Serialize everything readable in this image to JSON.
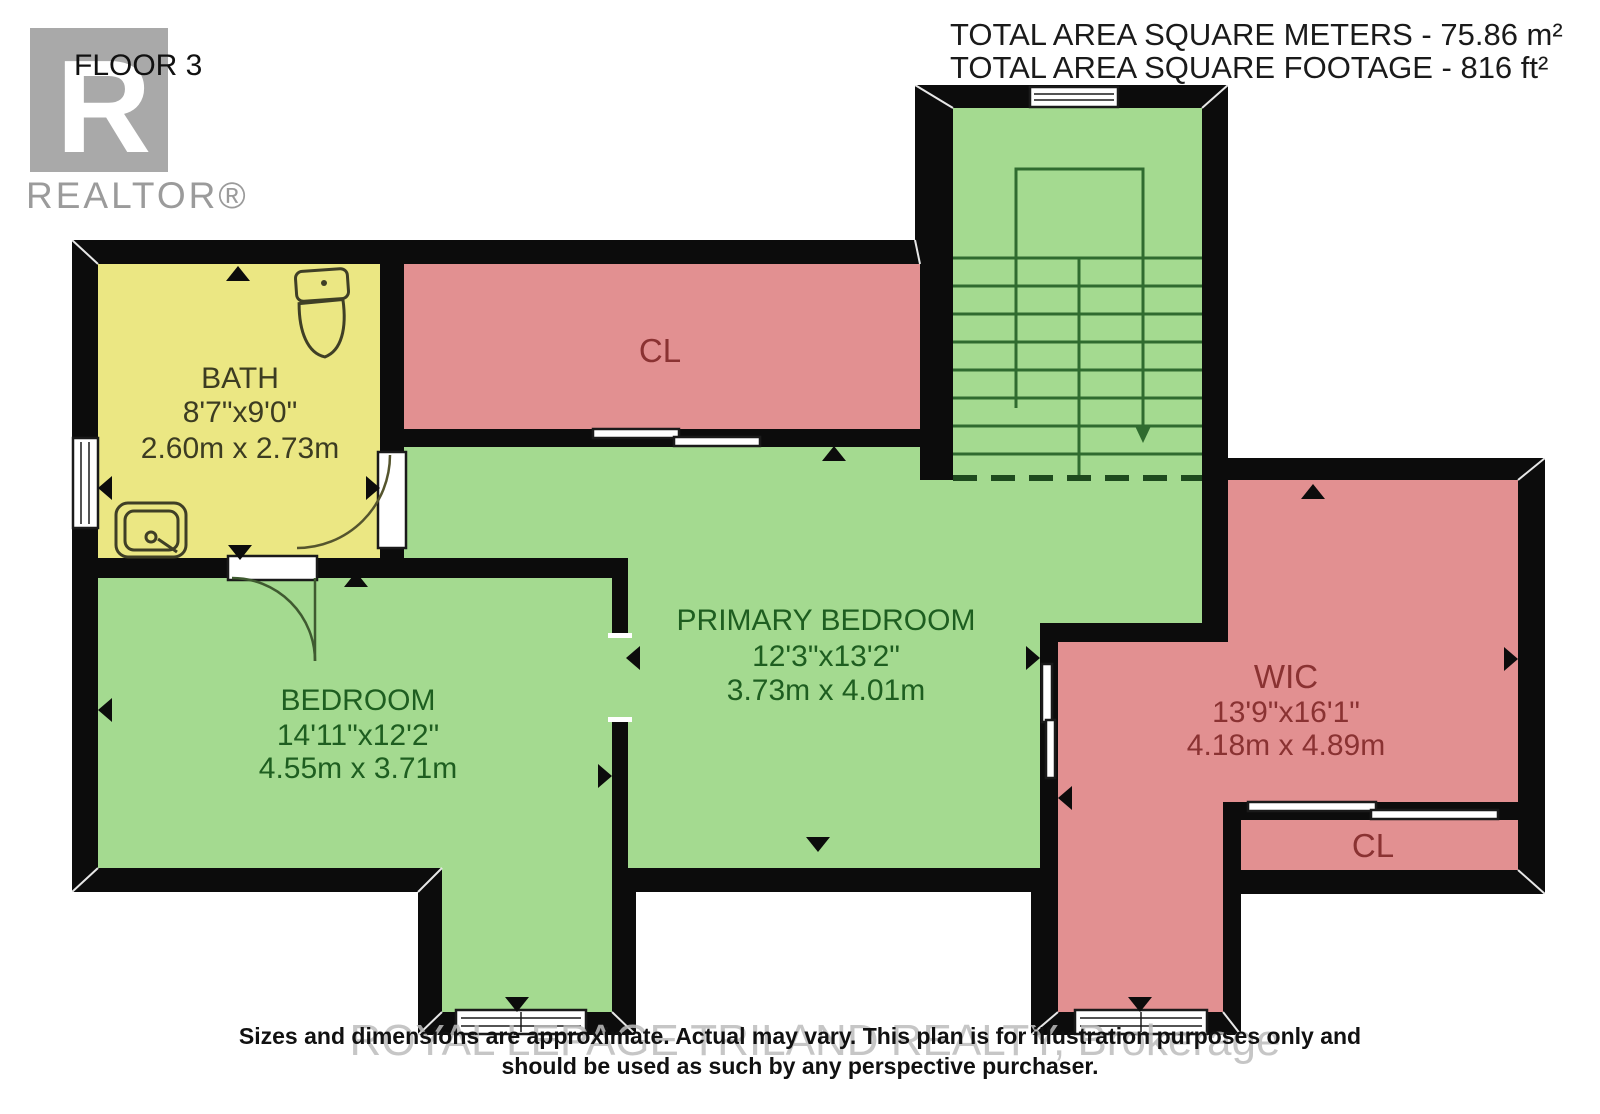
{
  "header": {
    "floor_label": "FLOOR 3",
    "area_metric": "TOTAL AREA SQUARE METERS - 75.86 m²",
    "area_imperial": "TOTAL AREA SQUARE FOOTAGE - 816 ft²"
  },
  "logo": {
    "letter": "R",
    "brand": "REALTOR®"
  },
  "rooms": {
    "bath": {
      "name": "BATH",
      "dim_ft": "8'7\"x9'0\"",
      "dim_m": "2.60m x 2.73m"
    },
    "closet_top": {
      "name": "CL"
    },
    "bedroom": {
      "name": "BEDROOM",
      "dim_ft": "14'11\"x12'2\"",
      "dim_m": "4.55m x 3.71m"
    },
    "primary_bedroom": {
      "name": "PRIMARY BEDROOM",
      "dim_ft": "12'3\"x13'2\"",
      "dim_m": "3.73m x 4.01m"
    },
    "wic": {
      "name": "WIC",
      "dim_ft": "13'9\"x16'1\"",
      "dim_m": "4.18m x 4.89m"
    },
    "closet_bottom": {
      "name": "CL"
    }
  },
  "footer": {
    "watermark": "ROYAL LEPAGE TRILAND REALTY, Brokerage",
    "disclaimer_line1": "Sizes and dimensions are approximate. Actual may vary. This plan is for illustration purposes only and",
    "disclaimer_line2": "should be used as such by any perspective purchaser."
  },
  "colors": {
    "wall": "#0c0c0c",
    "bath_yellow": "#ebe783",
    "closet_pink": "#e29091",
    "green": "#a4da90",
    "wic_pink": "#e29091",
    "logo_gray": "#a9a9a9"
  }
}
